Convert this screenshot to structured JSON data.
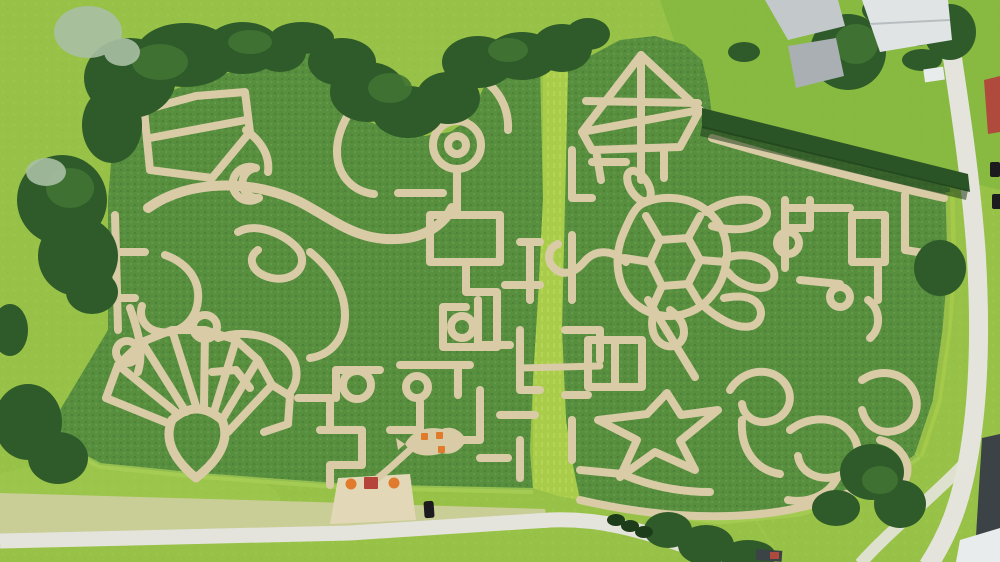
{
  "scene": {
    "description": "Aerial drone photo of two adjacent corn mazes in summer",
    "objects": {
      "left_maze": "corn maze with seashell fan, spirals, ring-and-square chain and curved fish-like paths",
      "right_maze": "corn maze with sailboat, sea turtle, starfish and wave/puzzle curls",
      "divider_strip": "light green mown strip separating the two maze fields",
      "tree_border": "dark tree belt along top-left of the fields",
      "hedge": "diagonal trimmed hedge on upper right field edge",
      "farm_buildings": "gray-roofed farm buildings at top right",
      "red_roof_building": "red-roofed building at right edge",
      "dark_roof_building": "dark-roofed building at bottom right corner",
      "entrance": "sandy entrance plaza with red kiosk and orange umbrellas",
      "fish_clearing": "fish-shaped clearing with orange picnic tables",
      "bottom_road": "light field road along the bottom",
      "right_road": "paved road along the right edge",
      "car": "black car parked on the bottom road"
    }
  },
  "colors": {
    "grass": "#98c247",
    "grass_deep": "#7cb23a",
    "grass_patch": "#a8cf57",
    "corn": "#578f3f",
    "corn_dark": "#46762f",
    "corn_light": "#73a855",
    "path": "#d8cba6",
    "path_light": "#e2d7b6",
    "strip": "#a9cc4b",
    "strip_light": "#c0dc62",
    "stubble": "#c9cd96",
    "road": "#e4e4dc",
    "trees_dark": "#2e5b29",
    "trees_mid": "#417433",
    "trees_light": "#5f9a42",
    "trees_pale": "#a9bfa3",
    "hedge": "#2a5426",
    "hedge_shadow": "#1d3c1a",
    "roof_gray": "#c3c8cb",
    "roof_gray_dark": "#a9afb3",
    "roof_white": "#e0e4e5",
    "roof_red": "#b04a3c",
    "building_dark": "#3c4347",
    "wall_white": "#e9ecec",
    "kiosk_red": "#b5443a",
    "umbrella_orange": "#e07b2e",
    "car_black": "#1c1c1e",
    "shadow": "#234a20"
  }
}
